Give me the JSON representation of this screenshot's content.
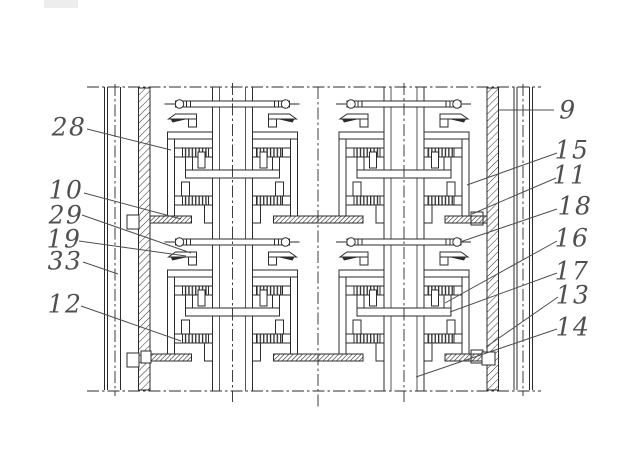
{
  "figure": {
    "kind": "patent-sectional-drawing",
    "background_color": "#ffffff",
    "line_color": "#2b2b2b",
    "label_color": "#4f4f4f",
    "reference_labels": {
      "left": [
        "28",
        "10",
        "29",
        "19",
        "33",
        "12"
      ],
      "right": [
        "9",
        "15",
        "11",
        "18",
        "16",
        "17",
        "13",
        "14"
      ]
    }
  }
}
